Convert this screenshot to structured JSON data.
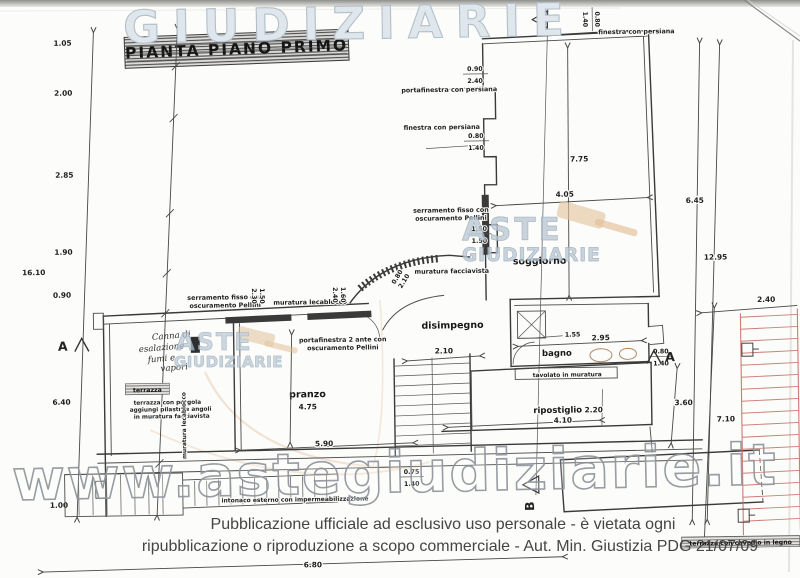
{
  "page": {
    "title": "PIANTA PIANO PRIMO",
    "footer_line1": "Pubblicazione ufficiale ad esclusivo uso personale - è vietata ogni",
    "footer_line2": "ripubblicazione o riproduzione a scopo commerciale - Aut. Min. Giustizia PDG 21/07/09"
  },
  "watermarks": {
    "brand_top": "GIUDIZIARIE",
    "brand_aste": "ASTE",
    "brand_giudiziarie": "GIUDIZIARIE",
    "site_url": "www.astegiudiziarie.it"
  },
  "rooms": {
    "soggiorno": "soggiorno",
    "bagno": "bagno",
    "disimpegno": "disimpegno",
    "pranzo": "pranzo",
    "terrazza": "terrazza",
    "ripostiglio": "ripostiglio"
  },
  "annotations": {
    "finestra_persiana": "finestra con persiana",
    "portafinestra_persiana": "portafinestra con persiana",
    "portafinestra_2ante": "portafinestra 2 ante con",
    "oscuramento_pellini": "oscuramento Pellini",
    "serramento_fisso": "serramento fisso con",
    "muratura_facciavista": "muratura facciavista",
    "muratura_lecablocco": "muratura lecablocco",
    "tavolato_muratura": "tavolato in muratura",
    "intonaco_esterno": "intonaco esterno con impermeabilizzazione",
    "terrazza_nota1": "terrazza con pergola",
    "terrazza_nota2": "aggiungi pilastri e angoli",
    "terrazza_nota3": "in muratura facciavista",
    "terrazza_cavedio": "terrazza con cavedio in legno",
    "canna1": "Canna di",
    "canna2": "esalazione",
    "canna3": "fumi e",
    "canna4": "vapori"
  },
  "sections": {
    "a": "A",
    "b": "B"
  },
  "dimensions": {
    "left_total": "16.10",
    "left_chain": [
      "1.05",
      "2.00",
      "2.85",
      "1.90",
      "0.90",
      "6.40",
      "1.00"
    ],
    "right_inner": "6.45",
    "right_outer": "12.95",
    "right_low_a": "3.60",
    "right_low_b": "7.10",
    "pergola_width": "2.40",
    "soggiorno_h": "7.75",
    "soggiorno_w": "4.05",
    "disimpegno_w": "2.10",
    "bagno_w": "2.95",
    "bagno_shower": "1.55",
    "pranzo_h": "4.75",
    "pranzo_w": "5.90",
    "ripostiglio_w": "4.10",
    "ripostiglio_d": "2.20",
    "bottom_w": "6.80",
    "pf_top": {
      "a": "0.90",
      "b": "2.40"
    },
    "win": {
      "a": "0.80",
      "b": "1.40"
    },
    "serr_left": {
      "a": "1.50",
      "b": "1.50"
    },
    "serr_top": {
      "a": "1.50",
      "b": "2.30"
    },
    "leca": {
      "a": "1.60",
      "b": "2.40"
    },
    "curve": {
      "a": "0.80",
      "b": "2.10"
    },
    "stair": {
      "a": "0.75",
      "b": "1.40"
    }
  },
  "colors": {
    "pergola_red": "#c4685c",
    "watermark_blue": "#b9c7d3",
    "watermark_gray": "#8f969c",
    "gavel_tan": "#e3c49e"
  }
}
